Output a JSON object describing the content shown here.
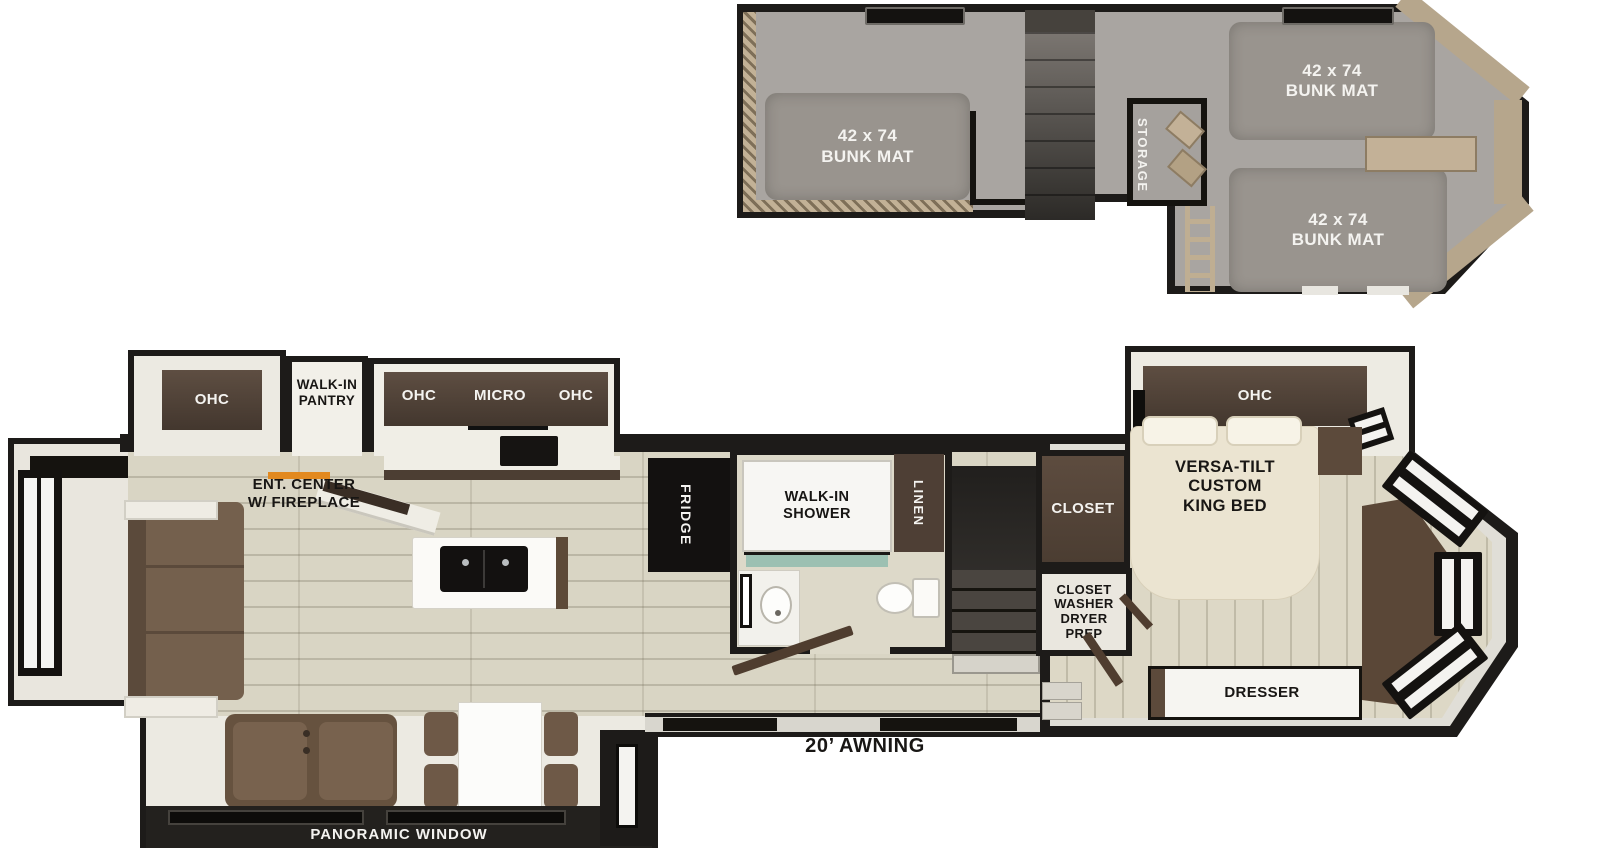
{
  "colors": {
    "wall": "#1d1b19",
    "carpet": "#a9a5a1",
    "wood_floor": "#d9d5c4",
    "cabinet_brown": "#54443a",
    "sofa_brown": "#74604d",
    "bed_cream": "#ebe4d1",
    "tile_teal": "#9cc0b2",
    "fireplace_orange": "#e2891f"
  },
  "loft": {
    "bunk_mat_left": "42 x 74\nBUNK MAT",
    "bunk_mat_top_right": "42 x 74\nBUNK MAT",
    "bunk_mat_bottom_right": "42 x 74\nBUNK MAT",
    "storage": "STORAGE"
  },
  "main_floor": {
    "living_ohc": "OHC",
    "pantry": "WALK-IN\nPANTRY",
    "kitchen_ohc_left": "OHC",
    "kitchen_micro": "MICRO",
    "kitchen_ohc_right": "OHC",
    "ent_center": "ENT. CENTER\nW/ FIREPLACE",
    "fridge": "FRIDGE",
    "shower": "WALK-IN\nSHOWER",
    "linen": "LINEN",
    "closet": "CLOSET",
    "washer_closet": "CLOSET\nWASHER\nDRYER\nPREP",
    "bedroom_ohc": "OHC",
    "king_bed": "VERSA-TILT\nCUSTOM\nKING BED",
    "dresser": "DRESSER",
    "panoramic_window": "PANORAMIC WINDOW",
    "awning": "20’ AWNING"
  }
}
